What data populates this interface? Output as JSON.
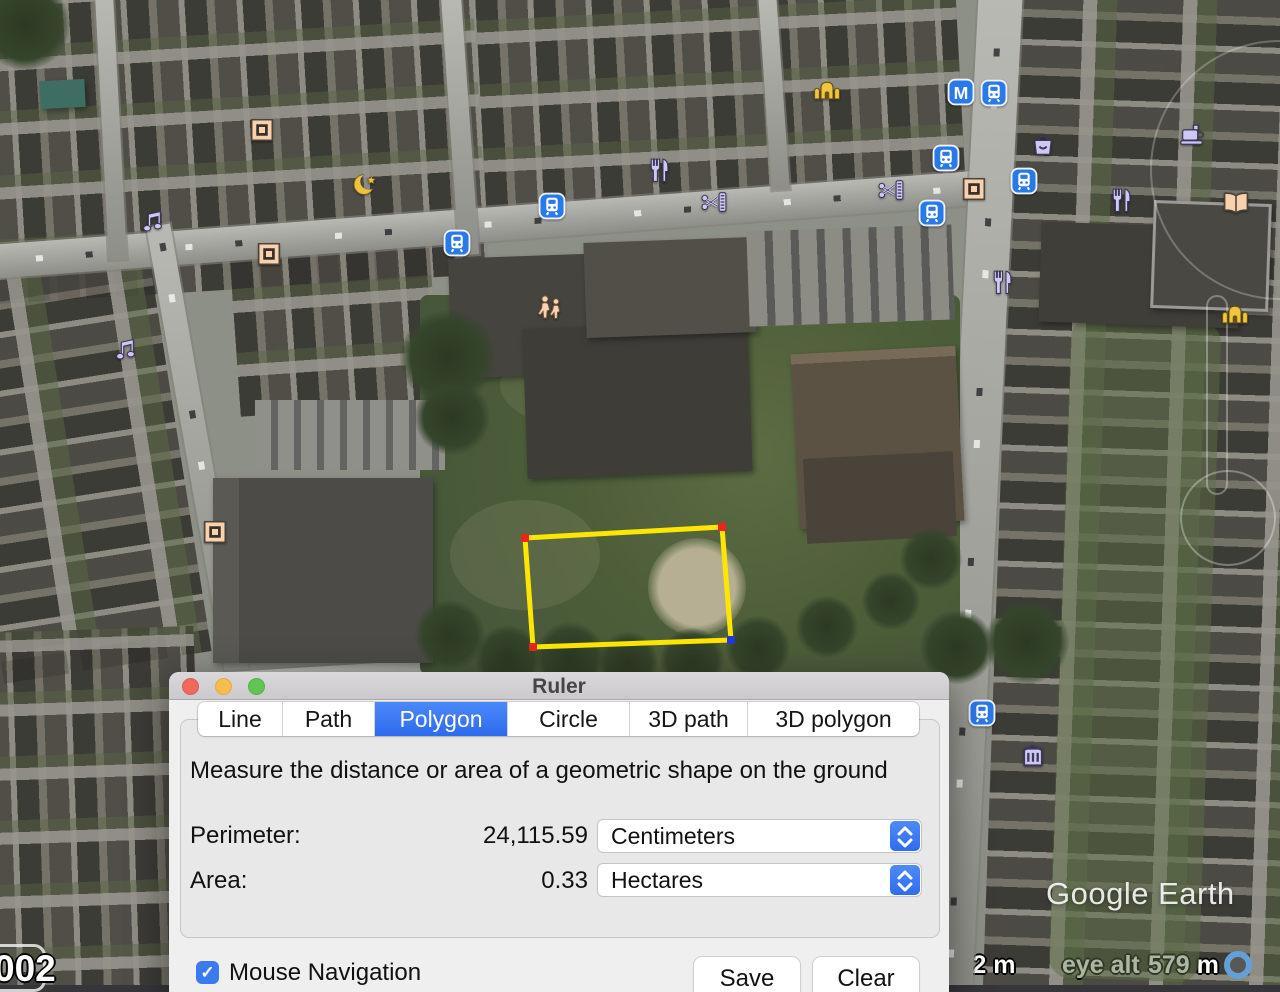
{
  "window": {
    "title": "Ruler",
    "tabs": [
      {
        "label": "Line",
        "selected": false
      },
      {
        "label": "Path",
        "selected": false
      },
      {
        "label": "Polygon",
        "selected": true
      },
      {
        "label": "Circle",
        "selected": false
      },
      {
        "label": "3D path",
        "selected": false
      },
      {
        "label": "3D polygon",
        "selected": false
      }
    ],
    "description": "Measure the distance or area of a geometric shape on the ground",
    "perimeter_label": "Perimeter:",
    "perimeter_value": "24,115.59",
    "perimeter_unit": "Centimeters",
    "area_label": "Area:",
    "area_value": "0.33",
    "area_unit": "Hectares",
    "checkbox_label": "Mouse Navigation",
    "checkbox_checked": true,
    "save_label": "Save",
    "clear_label": "Clear",
    "accent_color": "#3b7bf1"
  },
  "map": {
    "watermark": "Google Earth",
    "status": {
      "scale": "112 m",
      "eye_alt_label": "eye alt",
      "eye_alt_value": "579 m"
    },
    "corner_label": "002",
    "measure_polygon": {
      "stroke_color": "#ffe600",
      "vertices": [
        {
          "x": 525,
          "y": 538,
          "color": "#e82619"
        },
        {
          "x": 722,
          "y": 527,
          "color": "#e82619"
        },
        {
          "x": 731,
          "y": 640,
          "color": "#2637d8"
        },
        {
          "x": 533,
          "y": 647,
          "color": "#e82619"
        }
      ]
    },
    "icons": [
      {
        "type": "music-note",
        "x": 152,
        "y": 222
      },
      {
        "type": "music-note",
        "x": 125,
        "y": 350
      },
      {
        "type": "historic-square",
        "x": 262,
        "y": 130
      },
      {
        "type": "historic-square",
        "x": 269,
        "y": 254
      },
      {
        "type": "historic-square",
        "x": 974,
        "y": 189
      },
      {
        "type": "historic-square",
        "x": 215,
        "y": 532
      },
      {
        "type": "crescent",
        "x": 365,
        "y": 184
      },
      {
        "type": "worship",
        "x": 827,
        "y": 88
      },
      {
        "type": "worship",
        "x": 1235,
        "y": 312
      },
      {
        "type": "metro",
        "x": 961,
        "y": 92
      },
      {
        "type": "transit",
        "x": 994,
        "y": 93
      },
      {
        "type": "transit",
        "x": 552,
        "y": 206
      },
      {
        "type": "transit",
        "x": 457,
        "y": 243
      },
      {
        "type": "transit",
        "x": 946,
        "y": 158
      },
      {
        "type": "transit",
        "x": 1024,
        "y": 181
      },
      {
        "type": "transit",
        "x": 932,
        "y": 213
      },
      {
        "type": "transit",
        "x": 982,
        "y": 713
      },
      {
        "type": "restaurant",
        "x": 658,
        "y": 170
      },
      {
        "type": "restaurant",
        "x": 1001,
        "y": 282
      },
      {
        "type": "restaurant",
        "x": 1120,
        "y": 200
      },
      {
        "type": "barber",
        "x": 715,
        "y": 202
      },
      {
        "type": "barber",
        "x": 892,
        "y": 190
      },
      {
        "type": "shopping-bag",
        "x": 1043,
        "y": 145
      },
      {
        "type": "coffee",
        "x": 1193,
        "y": 135
      },
      {
        "type": "book",
        "x": 1236,
        "y": 203
      },
      {
        "type": "museum",
        "x": 1033,
        "y": 756
      },
      {
        "type": "people",
        "x": 550,
        "y": 307
      }
    ]
  }
}
